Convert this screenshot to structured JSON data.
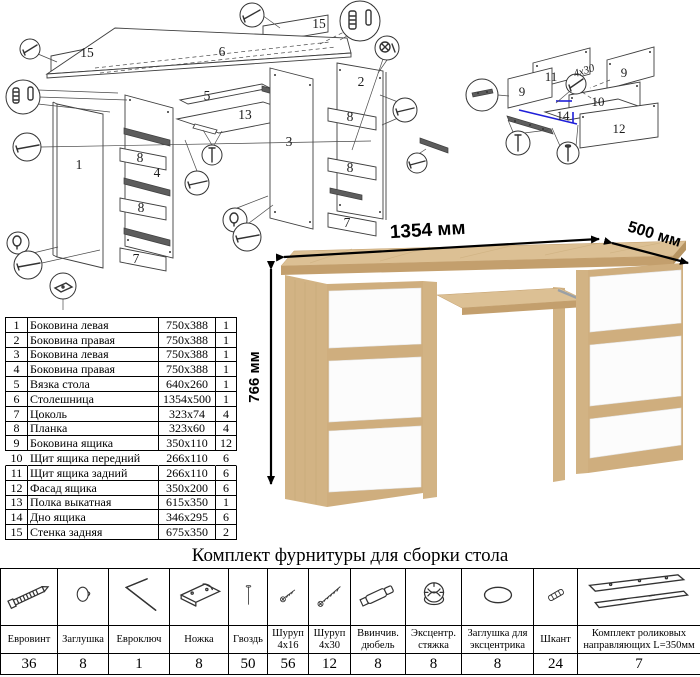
{
  "colors": {
    "line": "#3f3f3f",
    "highlight_blue": "#1f1fd9",
    "oak": "#dcc094",
    "oak_edge": "#c39f6d",
    "oak_side": "#d2b384",
    "oak_strip": "#cfae7e",
    "white_front": "#fcfcfc"
  },
  "main_diagram": {
    "labels": [
      {
        "t": "15",
        "x": 87,
        "y": 57
      },
      {
        "t": "6",
        "x": 222,
        "y": 56
      },
      {
        "t": "15",
        "x": 319,
        "y": 28
      },
      {
        "t": "5",
        "x": 207,
        "y": 100
      },
      {
        "t": "13",
        "x": 245,
        "y": 119
      },
      {
        "t": "3",
        "x": 289,
        "y": 146
      },
      {
        "t": "2",
        "x": 361,
        "y": 86
      },
      {
        "t": "1",
        "x": 79,
        "y": 169
      },
      {
        "t": "8",
        "x": 140,
        "y": 162
      },
      {
        "t": "4",
        "x": 157,
        "y": 177
      },
      {
        "t": "8",
        "x": 141,
        "y": 212
      },
      {
        "t": "7",
        "x": 136,
        "y": 263
      },
      {
        "t": "8",
        "x": 350,
        "y": 121
      },
      {
        "t": "8",
        "x": 350,
        "y": 172
      },
      {
        "t": "7",
        "x": 347,
        "y": 227
      }
    ]
  },
  "drawer_diagram": {
    "labels": [
      {
        "t": "11",
        "x": 551,
        "y": 81
      },
      {
        "t": "9",
        "x": 522,
        "y": 96
      },
      {
        "t": "9",
        "x": 624,
        "y": 77
      },
      {
        "t": "10",
        "x": 598,
        "y": 106
      },
      {
        "t": "14",
        "x": 563,
        "y": 120
      },
      {
        "t": "12",
        "x": 619,
        "y": 133
      }
    ],
    "note": "4x30"
  },
  "parts_table": {
    "rows": [
      [
        "1",
        "Боковина левая",
        "750x388",
        "1"
      ],
      [
        "2",
        "Боковина правая",
        "750x388",
        "1"
      ],
      [
        "3",
        "Боковина левая",
        "750x388",
        "1"
      ],
      [
        "4",
        "Боковина правая",
        "750x388",
        "1"
      ],
      [
        "5",
        "Вязка стола",
        "640x260",
        "1"
      ],
      [
        "6",
        "Столешница",
        "1354x500",
        "1"
      ],
      [
        "7",
        "Цоколь",
        "323x74",
        "4"
      ],
      [
        "8",
        "Планка",
        "323x60",
        "4"
      ],
      [
        "9",
        "Боковина ящика",
        "350x110",
        "12"
      ],
      [
        "10",
        "Щит ящика передний",
        "266x110",
        "6"
      ],
      [
        "11",
        "Щит ящика задний",
        "266x110",
        "6"
      ],
      [
        "12",
        "Фасад ящика",
        "350x200",
        "6"
      ],
      [
        "13",
        "Полка выкатная",
        "615x350",
        "1"
      ],
      [
        "14",
        "Дно ящика",
        "346x295",
        "6"
      ],
      [
        "15",
        "Стенка задняя",
        "675x350",
        "2"
      ]
    ]
  },
  "product": {
    "dim_width": "1354 мм",
    "dim_depth": "500 мм",
    "dim_height": "766 мм"
  },
  "hardware": {
    "title": "Комплект фурнитуры для сборки стола",
    "items": [
      {
        "name": "Евровинт",
        "qty": "36",
        "icon": "confirmat-screw-icon"
      },
      {
        "name": "Заглушка",
        "qty": "8",
        "icon": "cap-icon"
      },
      {
        "name": "Евроключ",
        "qty": "1",
        "icon": "hex-key-icon"
      },
      {
        "name": "Ножка",
        "qty": "8",
        "icon": "foot-icon"
      },
      {
        "name": "Гвоздь",
        "qty": "50",
        "icon": "nail-icon"
      },
      {
        "name": "Шуруп 4x16",
        "qty": "56",
        "icon": "screw-short-icon"
      },
      {
        "name": "Шуруп 4x30",
        "qty": "12",
        "icon": "screw-long-icon"
      },
      {
        "name": "Ввинчив. дюбель",
        "qty": "8",
        "icon": "dowel-screw-icon"
      },
      {
        "name": "Эксцентр. стяжка",
        "qty": "8",
        "icon": "cam-lock-icon"
      },
      {
        "name": "Заглушка для эксцентрика",
        "qty": "8",
        "icon": "cam-cap-icon"
      },
      {
        "name": "Шкант",
        "qty": "24",
        "icon": "wood-dowel-icon"
      },
      {
        "name": "Комплект роликовых направляющих L=350мм",
        "qty": "7",
        "icon": "drawer-slides-icon"
      }
    ]
  }
}
